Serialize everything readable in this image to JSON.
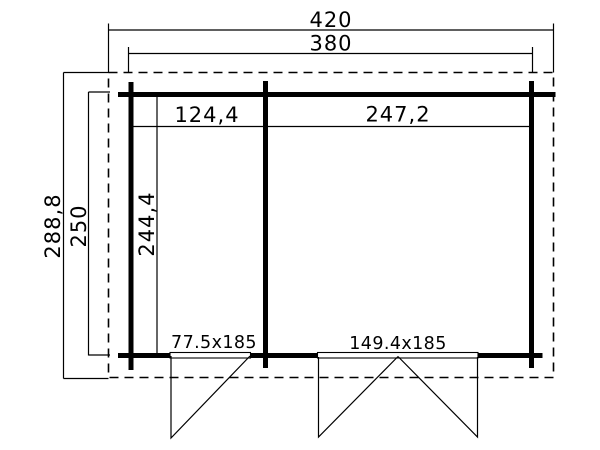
{
  "dimensions": {
    "overall_width": "420",
    "wall_width": "380",
    "overall_depth": "288,8",
    "wall_depth": "250",
    "left_bay_width": "124,4",
    "right_bay_width": "247,2",
    "interior_depth": "244,4"
  },
  "doors": {
    "single_door_label": "77.5x185",
    "double_door_label": "149.4x185"
  },
  "colors": {
    "line": "#000000",
    "background": "#ffffff"
  }
}
